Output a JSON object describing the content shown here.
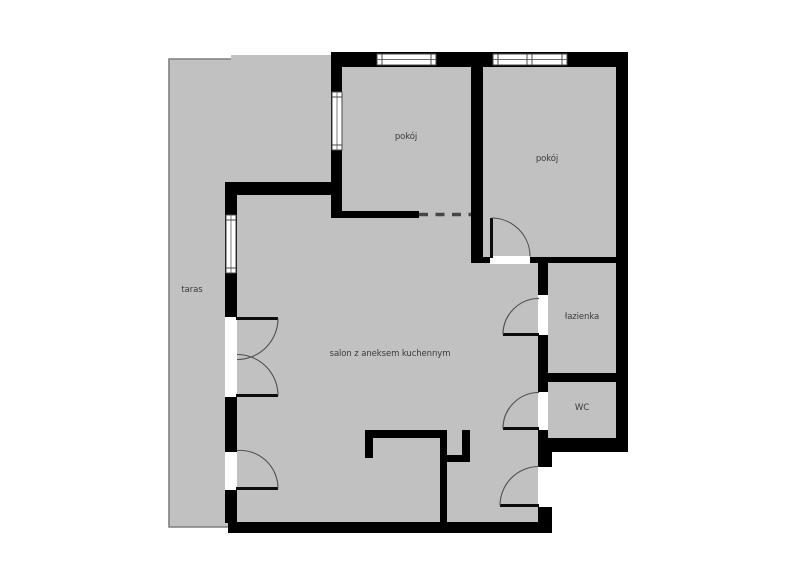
{
  "plan": {
    "type": "apartment-floor-plan",
    "rooms": {
      "taras": {
        "label": "taras"
      },
      "pokoj_top": {
        "label": "pokój"
      },
      "pokoj_right": {
        "label": "pokój"
      },
      "salon": {
        "label": "salon z aneksem kuchennym"
      },
      "lazienka": {
        "label": "łazienka"
      },
      "wc": {
        "label": "WC"
      }
    },
    "symbols": {
      "windows": [
        "window-top-left",
        "window-top-right",
        "window-pokoj-west",
        "window-taras-west"
      ],
      "doors": [
        "door-pokoj-right",
        "door-lazienka",
        "door-wc",
        "door-entrance",
        "french-door-taras",
        "door-taras-single"
      ],
      "other": [
        "dashed-opening-line",
        "kitchen-partition-walls"
      ]
    }
  },
  "colors": {
    "background": "#ffffff",
    "room_fill": "#c1c1c1",
    "terrace_fill": "#c1c1c1",
    "terrace_outline": "#7f7f7f",
    "wall": "#000000",
    "opening_fill": "#ffffff",
    "frame_stroke": "#4a4a4a",
    "label_text": "#3b3b3b"
  }
}
